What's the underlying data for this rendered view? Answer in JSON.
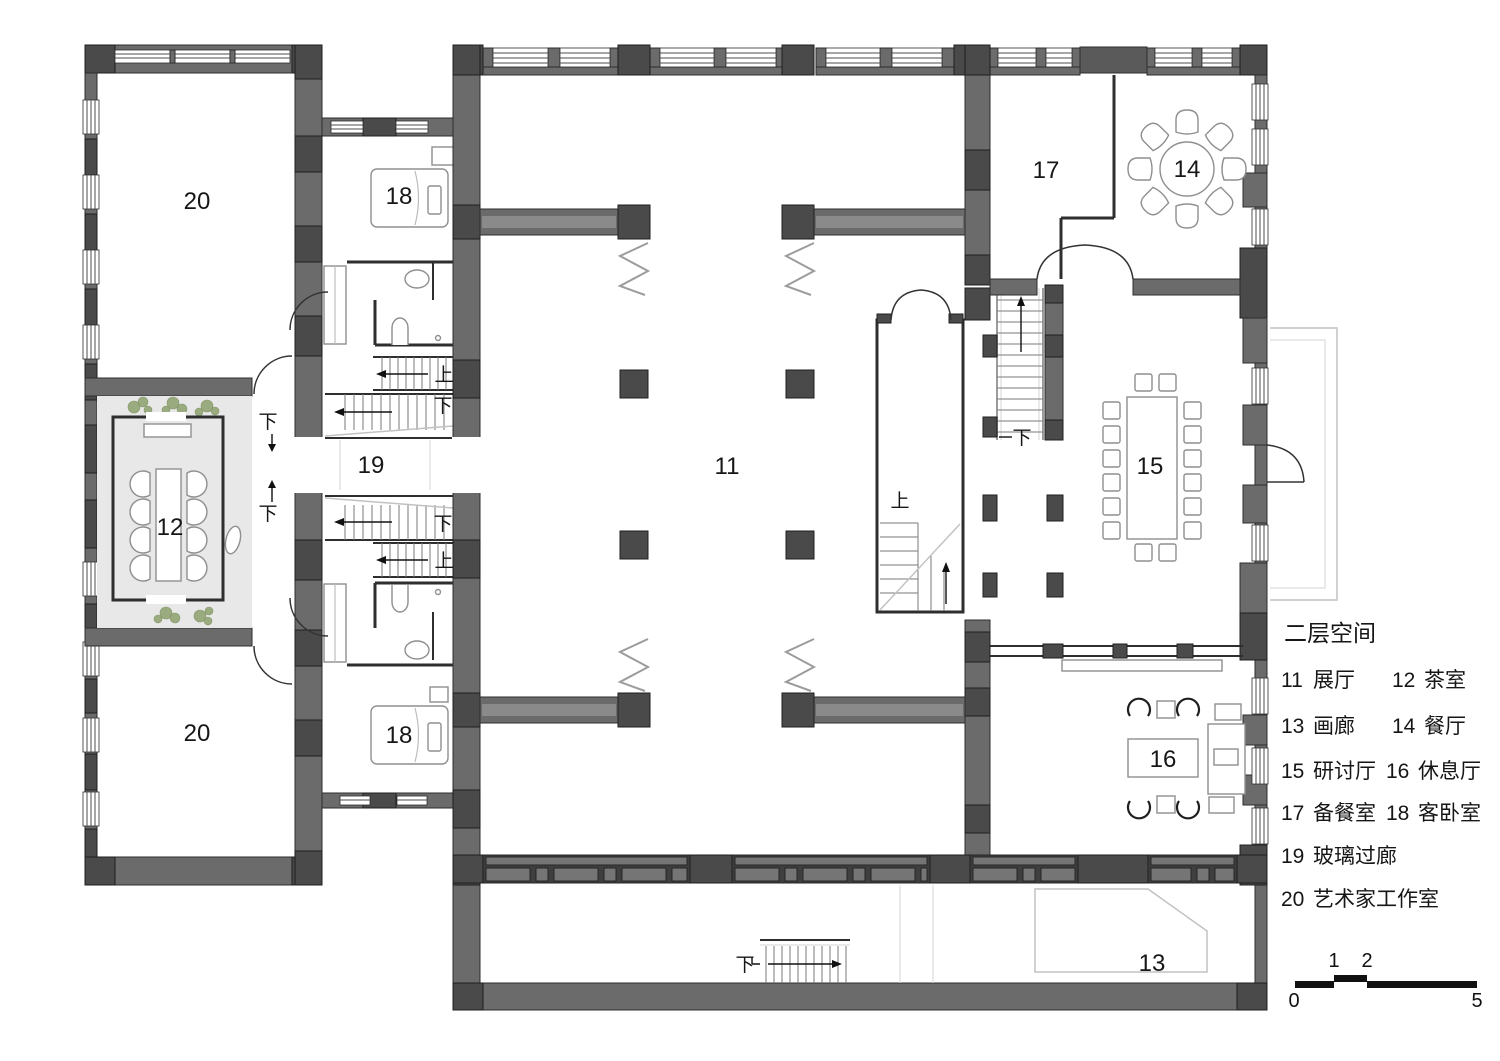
{
  "plan": {
    "rooms": {
      "hall": "11",
      "tea": "12",
      "gallery": "13",
      "dining": "14",
      "seminar": "15",
      "lounge": "16",
      "pantry": "17",
      "guest": "18",
      "glass_corridor": "19",
      "studio": "20"
    },
    "stairs": {
      "up": "上",
      "down": "下"
    }
  },
  "legend": {
    "title": "二层空间",
    "entries": [
      {
        "number": "11",
        "name": "展厅"
      },
      {
        "number": "12",
        "name": "茶室"
      },
      {
        "number": "13",
        "name": "画廊"
      },
      {
        "number": "14",
        "name": "餐厅"
      },
      {
        "number": "15",
        "name": "研讨厅"
      },
      {
        "number": "16",
        "name": "休息厅"
      },
      {
        "number": "17",
        "name": "备餐室"
      },
      {
        "number": "18",
        "name": "客卧室"
      },
      {
        "number": "19",
        "name": "玻璃过廊"
      },
      {
        "number": "20",
        "name": "艺术家工作室"
      }
    ]
  },
  "scale_bar": {
    "ticks": [
      "0",
      "1",
      "2",
      "5"
    ]
  }
}
